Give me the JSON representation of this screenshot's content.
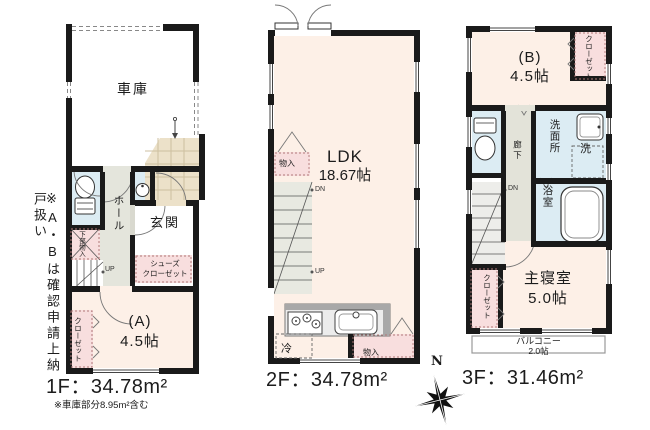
{
  "side_note": "※A・Bは確認申請上納戸扱い",
  "compass": {
    "north_label": "N"
  },
  "colors": {
    "wall": "#1a1a1a",
    "room_floor": "#fdf0e7",
    "wet_area": "#dcecf3",
    "closet_pink": "#f8dede",
    "hall_gray": "#e4e5dc",
    "tile_beige": "#ece1c9"
  },
  "floor1": {
    "label": "1F：34.78m²",
    "footnote": "※車庫部分8.95m²含む",
    "garage": "車庫",
    "hall": "ホール",
    "entrance": "玄関",
    "shoes_closet_line1": "シューズ",
    "shoes_closet_line2": "クローゼット",
    "under_stair_storage": "下部物入",
    "room_a_name": "(A)",
    "room_a_size": "4.5帖",
    "closet": "クローゼット",
    "up_label": "UP"
  },
  "floor2": {
    "label": "2F：34.78m²",
    "ldk_name": "LDK",
    "ldk_size": "18.67帖",
    "storage_left": "物入",
    "storage_right": "物入",
    "fridge": "冷",
    "dn_label": "DN",
    "up_label": "UP"
  },
  "floor3": {
    "label": "3F：31.46m²",
    "room_b_name": "(B)",
    "room_b_size": "4.5帖",
    "closet_b": "クローゼット",
    "corridor": "廊下",
    "washroom": "洗面所",
    "laundry": "洗",
    "bathroom": "浴室",
    "bedroom_name": "主寝室",
    "bedroom_size": "5.0帖",
    "closet_bedroom": "クローゼット",
    "balcony_name": "バルコニー",
    "balcony_size": "2.0帖",
    "dn_label": "DN"
  }
}
